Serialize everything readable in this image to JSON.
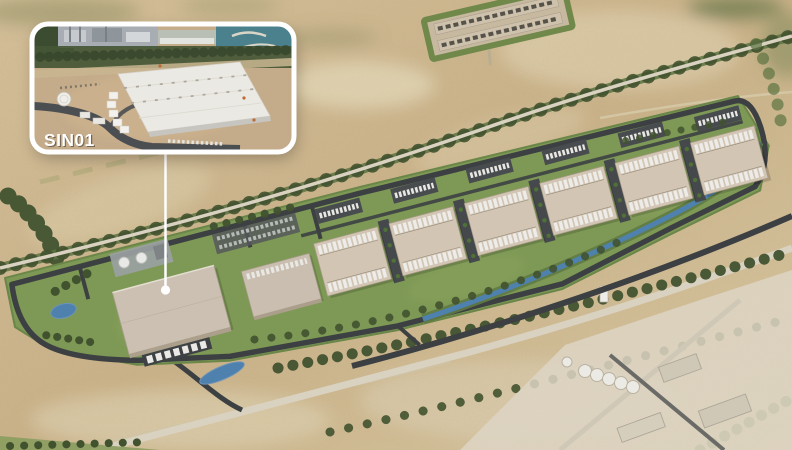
{
  "inset": {
    "label": "SIN01"
  },
  "colors": {
    "sand": "#cdb78e",
    "sand-pale": "#e4d7b6",
    "lawn": "#7e9955",
    "lawn-dark": "#6a8648",
    "veg-dark": "#41522f",
    "veg-mid": "#5d7342",
    "road-dark": "#3d4042",
    "road-light": "#d9d2c0",
    "hall-roof": "#d2c5b4",
    "unit-white": "#edece8",
    "apron": "#46494c",
    "water": "#4e81ae",
    "sea": "#4b808d",
    "inset-dirt": "#c4ab8a",
    "inset-roof": "#ebe9e4",
    "inset-border": "#ffffff",
    "label-white": "#ffffff"
  }
}
